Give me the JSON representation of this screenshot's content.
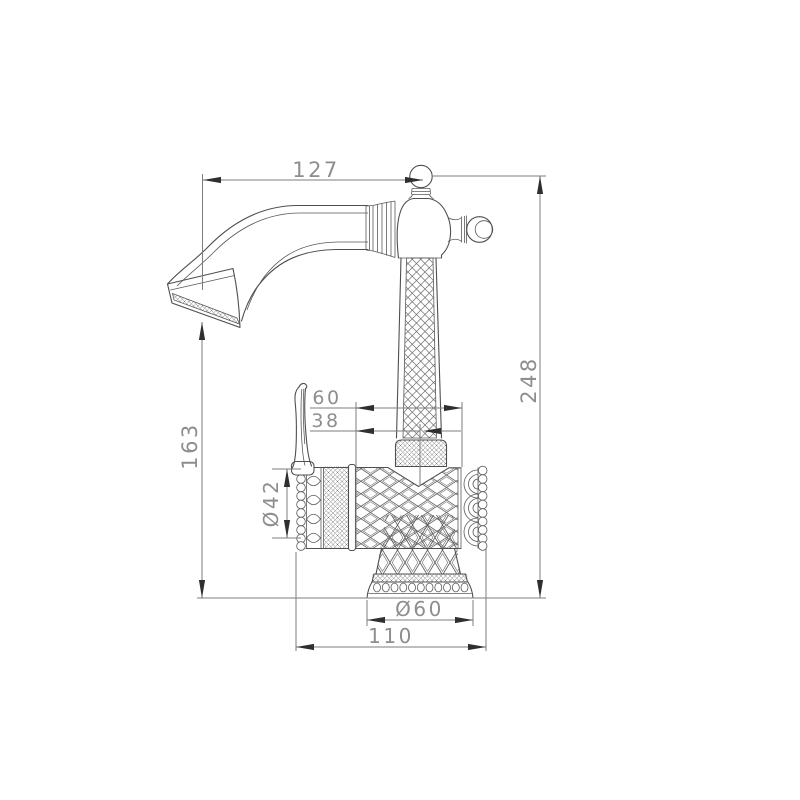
{
  "drawing": {
    "dimensions": {
      "spout_reach": "127",
      "overall_height": "248",
      "spout_outlet_height": "163",
      "head_width": "60",
      "head_offset": "38",
      "body_diameter": "Ø42",
      "base_diameter": "Ø60",
      "body_length": "110"
    },
    "colors": {
      "background": "#ffffff",
      "outline": "#4f4f4f",
      "dimension_line": "#7d7d7d",
      "arrow": "#2f2f2f",
      "label_text": "#8e8e8e"
    }
  }
}
